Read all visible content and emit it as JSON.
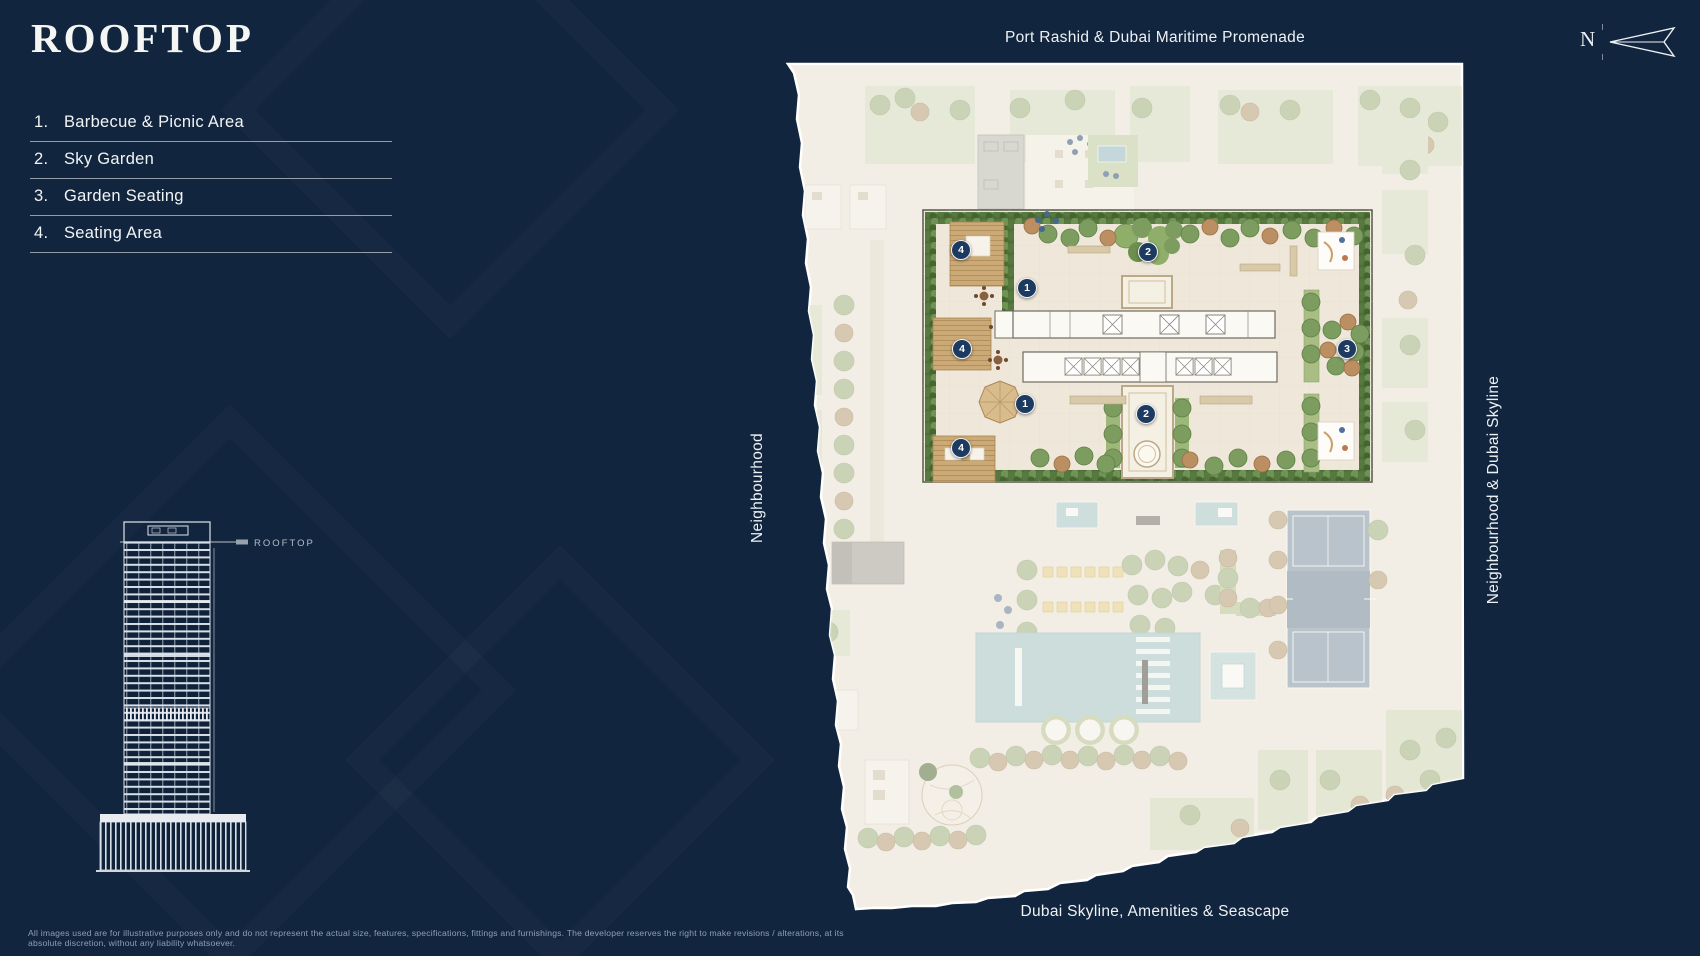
{
  "page": {
    "title": "ROOFTOP",
    "background": "#12253e",
    "disclaimer": "All images used are for illustrative purposes only and do not represent the actual size, features, specifications, fittings and furnishings. The developer reserves the right to make revisions / alterations, at its absolute discretion, without any liability whatsoever."
  },
  "legend": {
    "items": [
      {
        "number": "1.",
        "label": "Barbecue & Picnic Area"
      },
      {
        "number": "2.",
        "label": "Sky Garden"
      },
      {
        "number": "3.",
        "label": "Garden Seating"
      },
      {
        "number": "4.",
        "label": "Seating Area"
      }
    ]
  },
  "elevation": {
    "callout": "ROOFTOP"
  },
  "map": {
    "labels": {
      "top": "Port Rashid & Dubai Maritime Promenade",
      "bottom": "Dubai Skyline, Amenities & Seascape",
      "left": "Neighbourhood",
      "right": "Neighbourhood & Dubai Skyline"
    },
    "compass_letter": "N",
    "marker_color": "#1d3a60",
    "markers": [
      {
        "n": "4",
        "x": 961,
        "y": 250
      },
      {
        "n": "2",
        "x": 1148,
        "y": 252
      },
      {
        "n": "1",
        "x": 1027,
        "y": 288
      },
      {
        "n": "4",
        "x": 962,
        "y": 349
      },
      {
        "n": "3",
        "x": 1347,
        "y": 349
      },
      {
        "n": "1",
        "x": 1025,
        "y": 404
      },
      {
        "n": "2",
        "x": 1146,
        "y": 414
      },
      {
        "n": "4",
        "x": 961,
        "y": 448
      }
    ]
  }
}
